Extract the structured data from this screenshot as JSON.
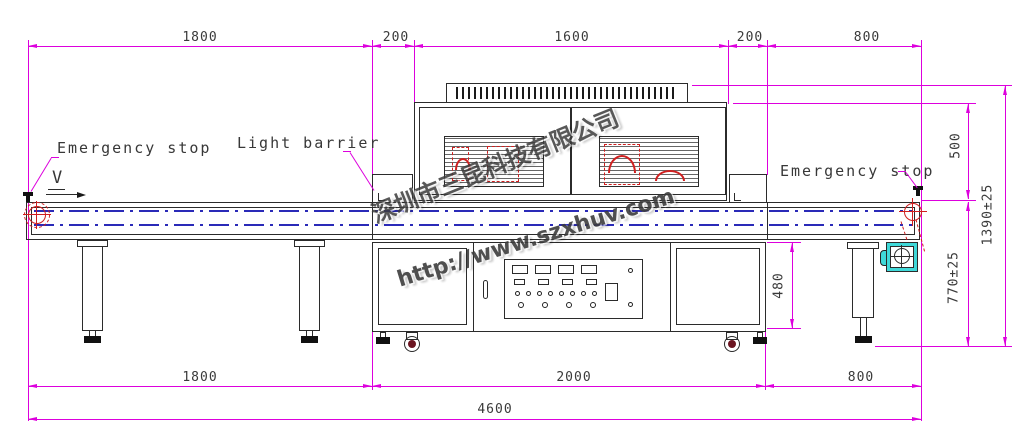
{
  "drawing": {
    "labels": {
      "emergency_stop_left": "Emergency stop",
      "light_barrier": "Light barrier",
      "emergency_stop_right": "Emergency stop",
      "direction_v": "V"
    },
    "dimensions_mm": {
      "top": [
        "1800",
        "200",
        "1600",
        "200",
        "800"
      ],
      "bottom": [
        "1800",
        "2000",
        "800"
      ],
      "overall_length": "4600",
      "lamp_house_height": "500",
      "total_height": "1390±25",
      "belt_height": "770±25",
      "cabinet_height": "480"
    },
    "watermark": {
      "company": "深圳市三昆科技有限公司",
      "website": "http://www.szxhuv.com"
    },
    "colors": {
      "dimension_lines": "#dd00dd",
      "outline": "#2b2b2b",
      "belt_centerline": "#2a2ab8",
      "roller_marks": "#cf1f1f",
      "motor_fill": "#3fd9d9"
    }
  }
}
